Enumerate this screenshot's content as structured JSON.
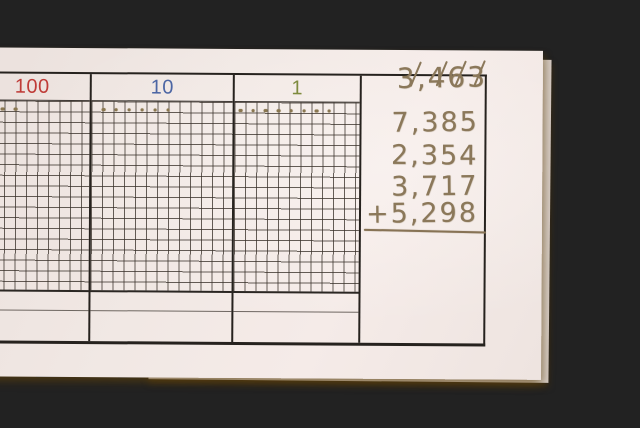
{
  "scene": {
    "desk_color": "#cda342",
    "paper_color": "#f1e8e4",
    "pencil_color": "#8b785a"
  },
  "worksheet": {
    "columns": [
      {
        "id": "hundreds",
        "label": "100",
        "label_color": "#bf3c38",
        "dot_count": 2
      },
      {
        "id": "tens",
        "label": "10",
        "label_color": "#4c66a4",
        "dot_count": 6
      },
      {
        "id": "ones",
        "label": "1",
        "label_color": "#7e8b3e",
        "dot_count": 8
      }
    ],
    "lines": [
      {
        "text": "3,463",
        "crossed_out": true
      },
      {
        "text": "7,385"
      },
      {
        "text": "2,354"
      },
      {
        "text": "3,717"
      },
      {
        "text": "+5,298",
        "underlined": true
      }
    ]
  }
}
